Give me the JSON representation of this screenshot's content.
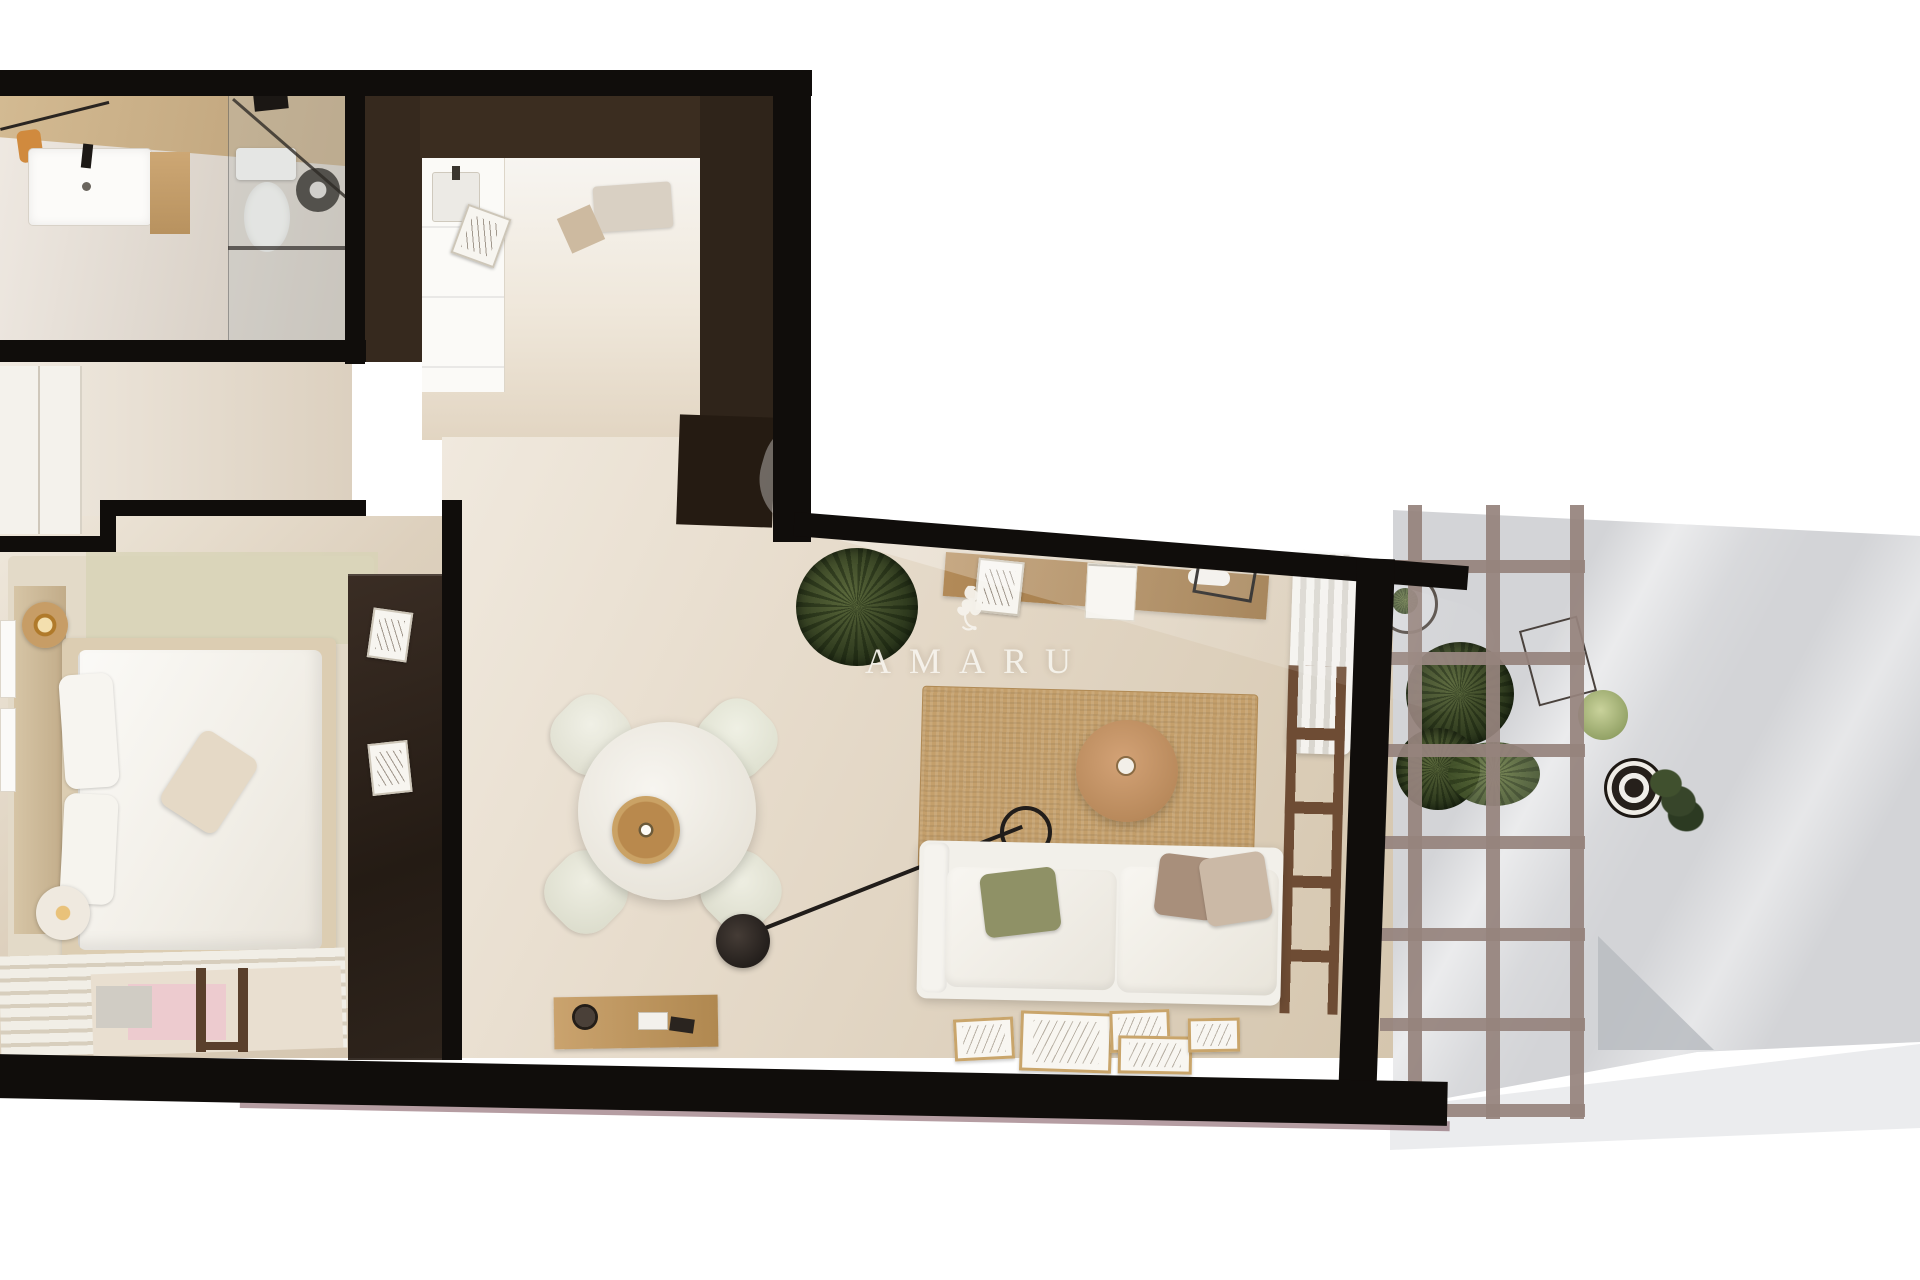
{
  "watermark": {
    "text": "AMARU",
    "logo": "griffin-logo-icon"
  },
  "palette": {
    "background": "#ffffff",
    "wall_black": "#100d0b",
    "cabinet_brown": "#34291f",
    "wardrobe_brown": "#2c2219",
    "floor_beige": "#ddd1c0",
    "floor_light": "#f1ece4",
    "counter_wood": "#c5ab83",
    "terrace_gray": "#d3d4d7",
    "terrace_edge": "#ebecee",
    "pergola_mauve": "#97827c",
    "jute_rug": "#c49f6b",
    "wood_mid": "#ab8757",
    "plant_green": "#3c4527",
    "sofa_white": "#f2f0ea",
    "pillow_green": "#8f9166",
    "pillow_brown": "#a88f7b",
    "towel_orange": "#d08a3e",
    "rug_pink": "#edcbcf",
    "baseboard_maroon": "#6b3c45",
    "watermark_white": "#f6f3ec"
  }
}
